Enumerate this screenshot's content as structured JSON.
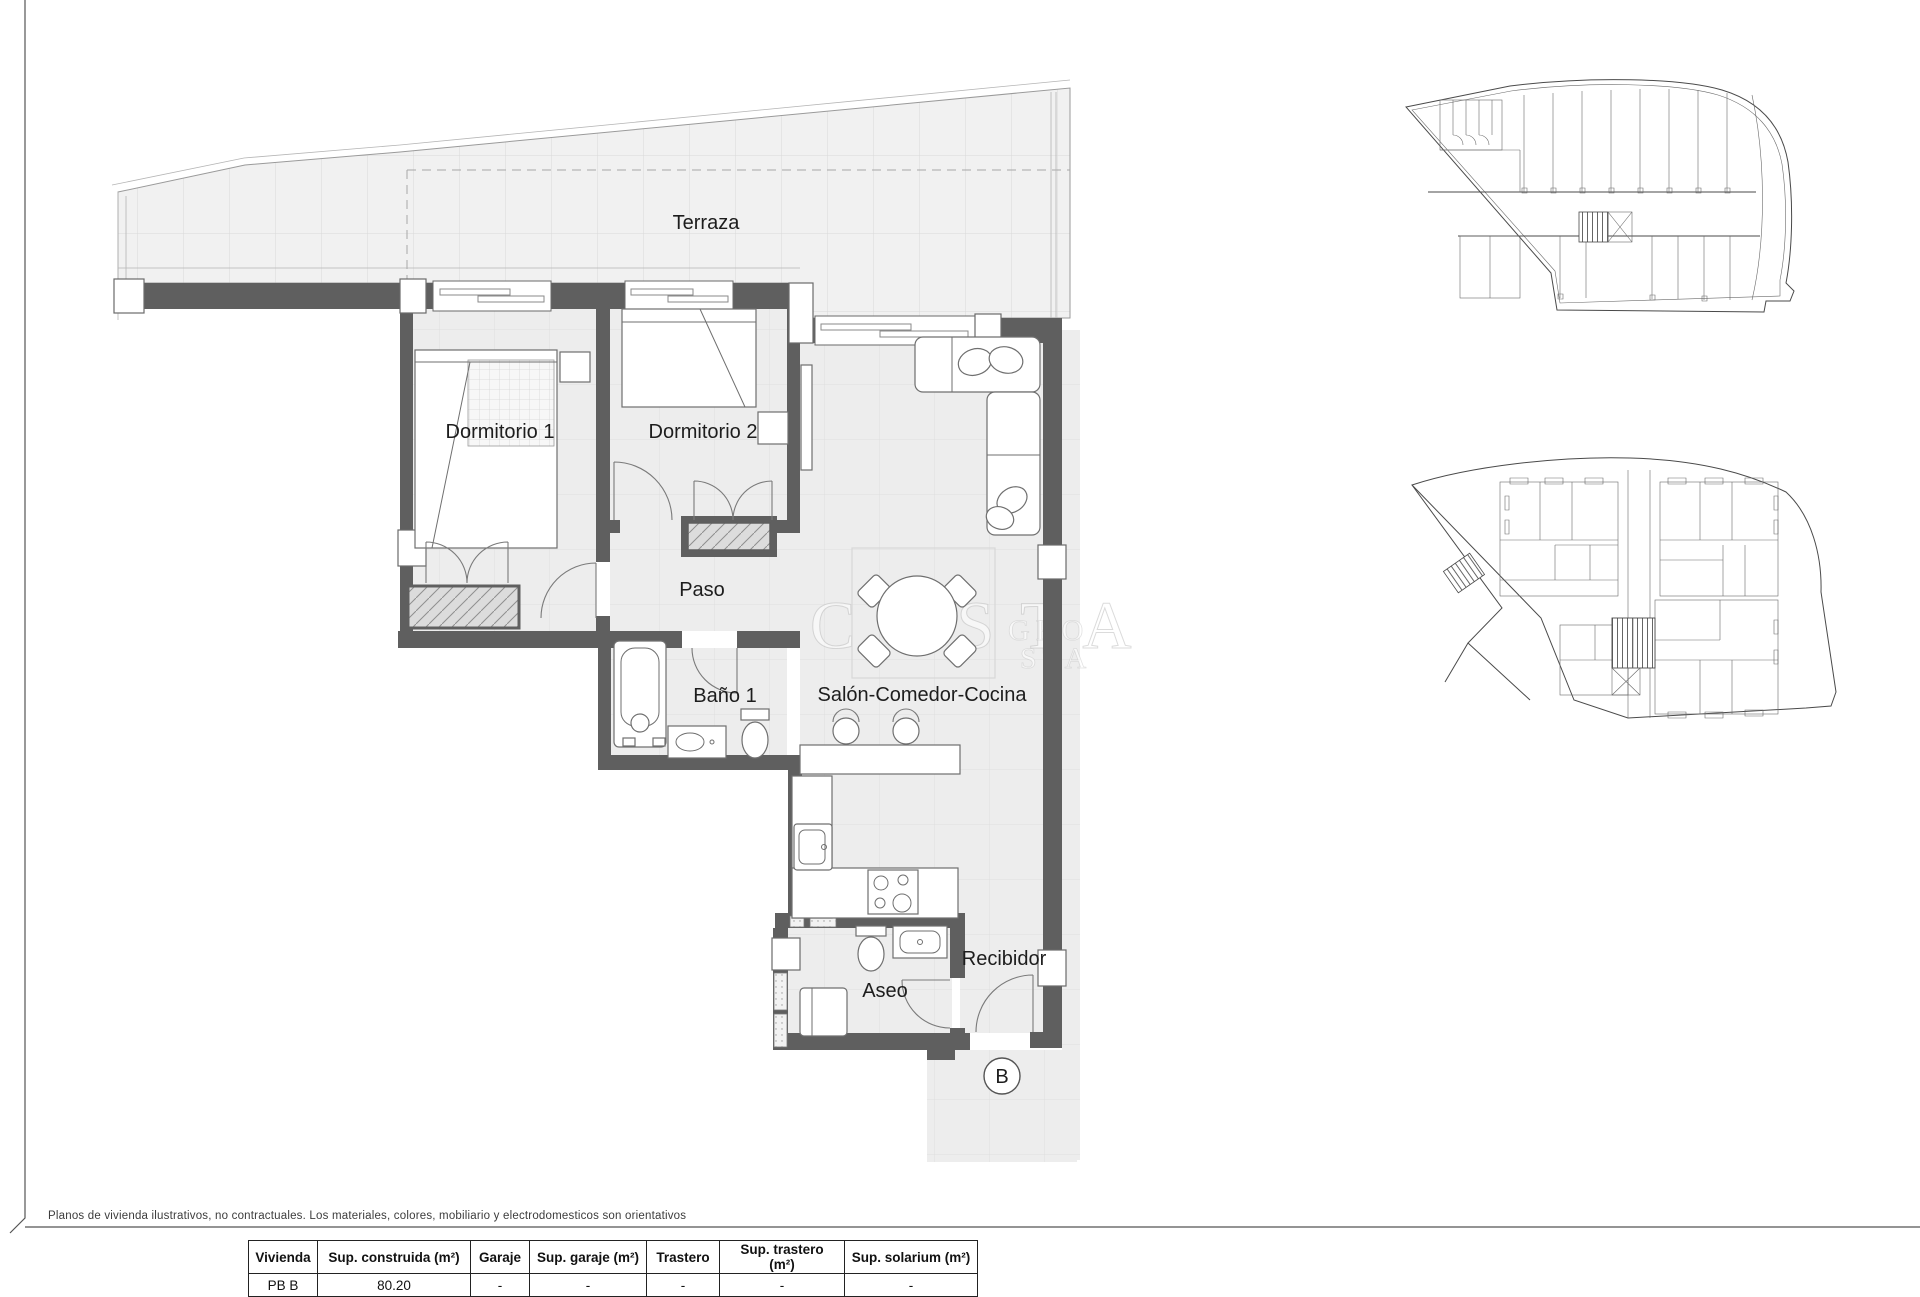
{
  "page": {
    "disclaimer": "Planos de vivienda ilustrativos, no contractuales. Los materiales, colores, mobiliario y electrodomesticos son orientativos"
  },
  "watermark": {
    "main": "COSTA",
    "sub_top": "GRO",
    "sub_bottom": "STA"
  },
  "plan": {
    "rooms": {
      "terraza": "Terraza",
      "dormitorio1": "Dormitorio 1",
      "dormitorio2": "Dormitorio 2",
      "paso": "Paso",
      "bano1": "Baño 1",
      "salon": "Salón-Comedor-Cocina",
      "aseo": "Aseo",
      "recibidor": "Recibidor"
    },
    "unit_marker": "B"
  },
  "table": {
    "headers": [
      "Vivienda",
      "Sup. construida (m²)",
      "Garaje",
      "Sup. garaje (m²)",
      "Trastero",
      "Sup. trastero (m²)",
      "Sup. solarium (m²)"
    ],
    "rows": [
      [
        "PB B",
        "80.20",
        "-",
        "-",
        "-",
        "-",
        "-"
      ]
    ]
  },
  "colors": {
    "wall": "#5f5f5f",
    "floor": "#ededed",
    "grid_line": "#dfdfdf",
    "terrace": "#f1f1f1"
  }
}
